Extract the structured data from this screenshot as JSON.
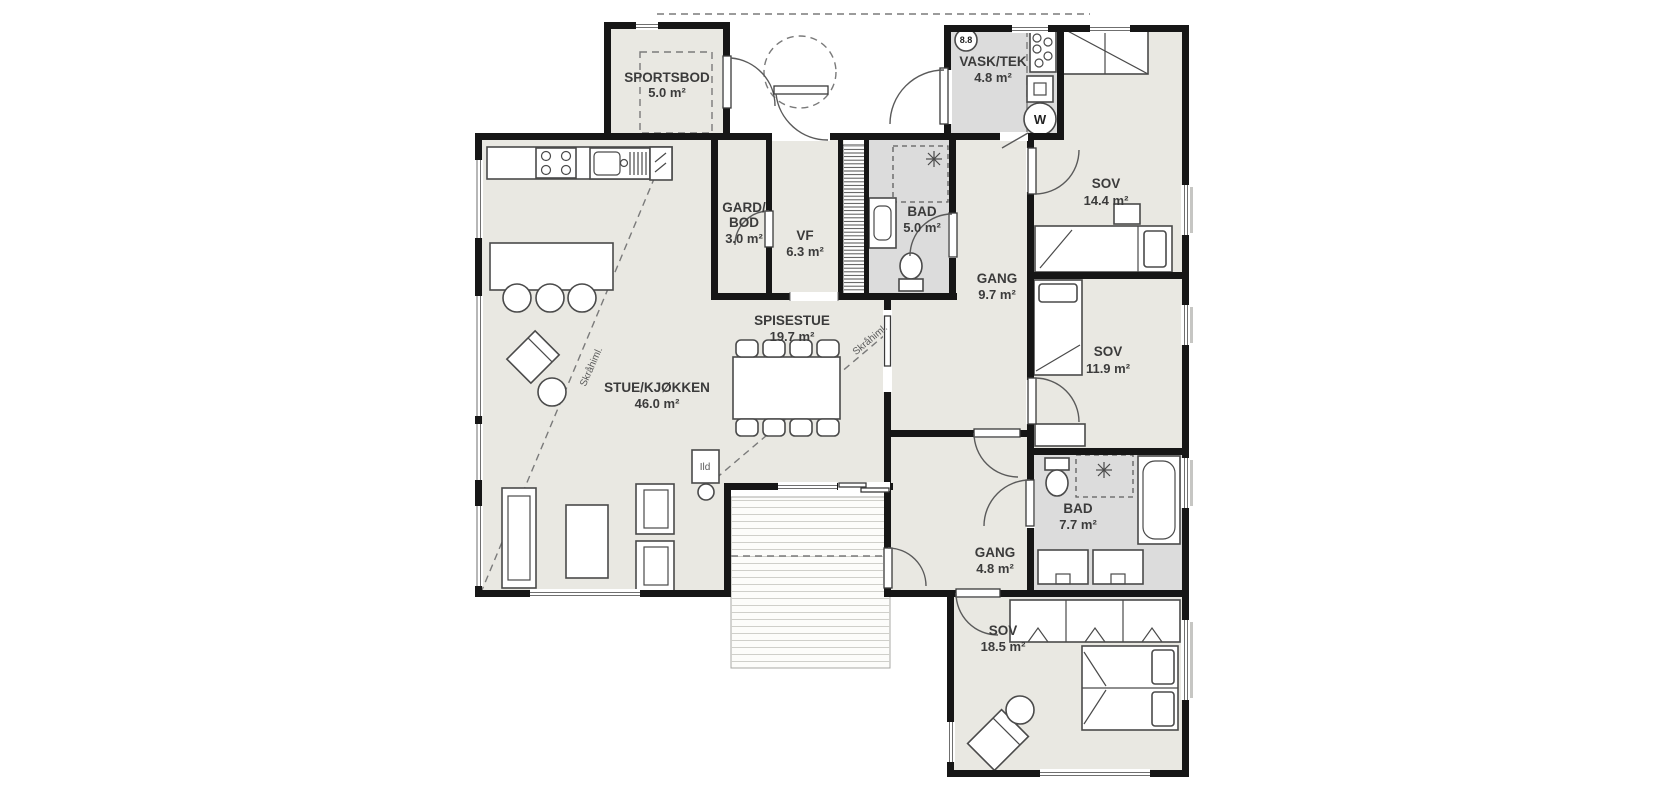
{
  "plan": {
    "title": "Floor plan",
    "language": "Norwegian",
    "area_unit": "m²",
    "rooms": [
      {
        "id": "sportsbod",
        "name": "SPORTSBOD",
        "area": "5.0 m²"
      },
      {
        "id": "vask_tek",
        "name": "VASK/TEK",
        "area": "4.8 m²"
      },
      {
        "id": "sov_1",
        "name": "SOV",
        "area": "14.4 m²"
      },
      {
        "id": "gard_bod",
        "name": "GARD/BOD",
        "name_line1": "GARD/",
        "name_line2": "BOD",
        "area": "3.0 m²"
      },
      {
        "id": "vf",
        "name": "VF",
        "area": "6.3 m²"
      },
      {
        "id": "bad_1",
        "name": "BAD",
        "area": "5.0 m²"
      },
      {
        "id": "gang_1",
        "name": "GANG",
        "area": "9.7 m²"
      },
      {
        "id": "spisestue",
        "name": "SPISESTUE",
        "area": "19.7 m²"
      },
      {
        "id": "stue_kjokken",
        "name": "STUE/KJØKKEN",
        "area": "46.0 m²"
      },
      {
        "id": "sov_2",
        "name": "SOV",
        "area": "11.9 m²"
      },
      {
        "id": "bad_2",
        "name": "BAD",
        "area": "7.7 m²"
      },
      {
        "id": "gang_2",
        "name": "GANG",
        "area": "4.8 m²"
      },
      {
        "id": "sov_3",
        "name": "SOV",
        "area": "18.5 m²"
      }
    ],
    "annotations": {
      "sloped_ceiling": "Skråhiml.",
      "fireplace": "Ild",
      "ceiling_height_marker": "8.8",
      "washing_machine": "W"
    },
    "colors": {
      "wall": "#161616",
      "room_fill": "#e9e8e2",
      "wet_room_fill": "#dcdcdc",
      "furniture_line": "#4a4a4a",
      "dashed_line": "#7a7a7a"
    }
  }
}
